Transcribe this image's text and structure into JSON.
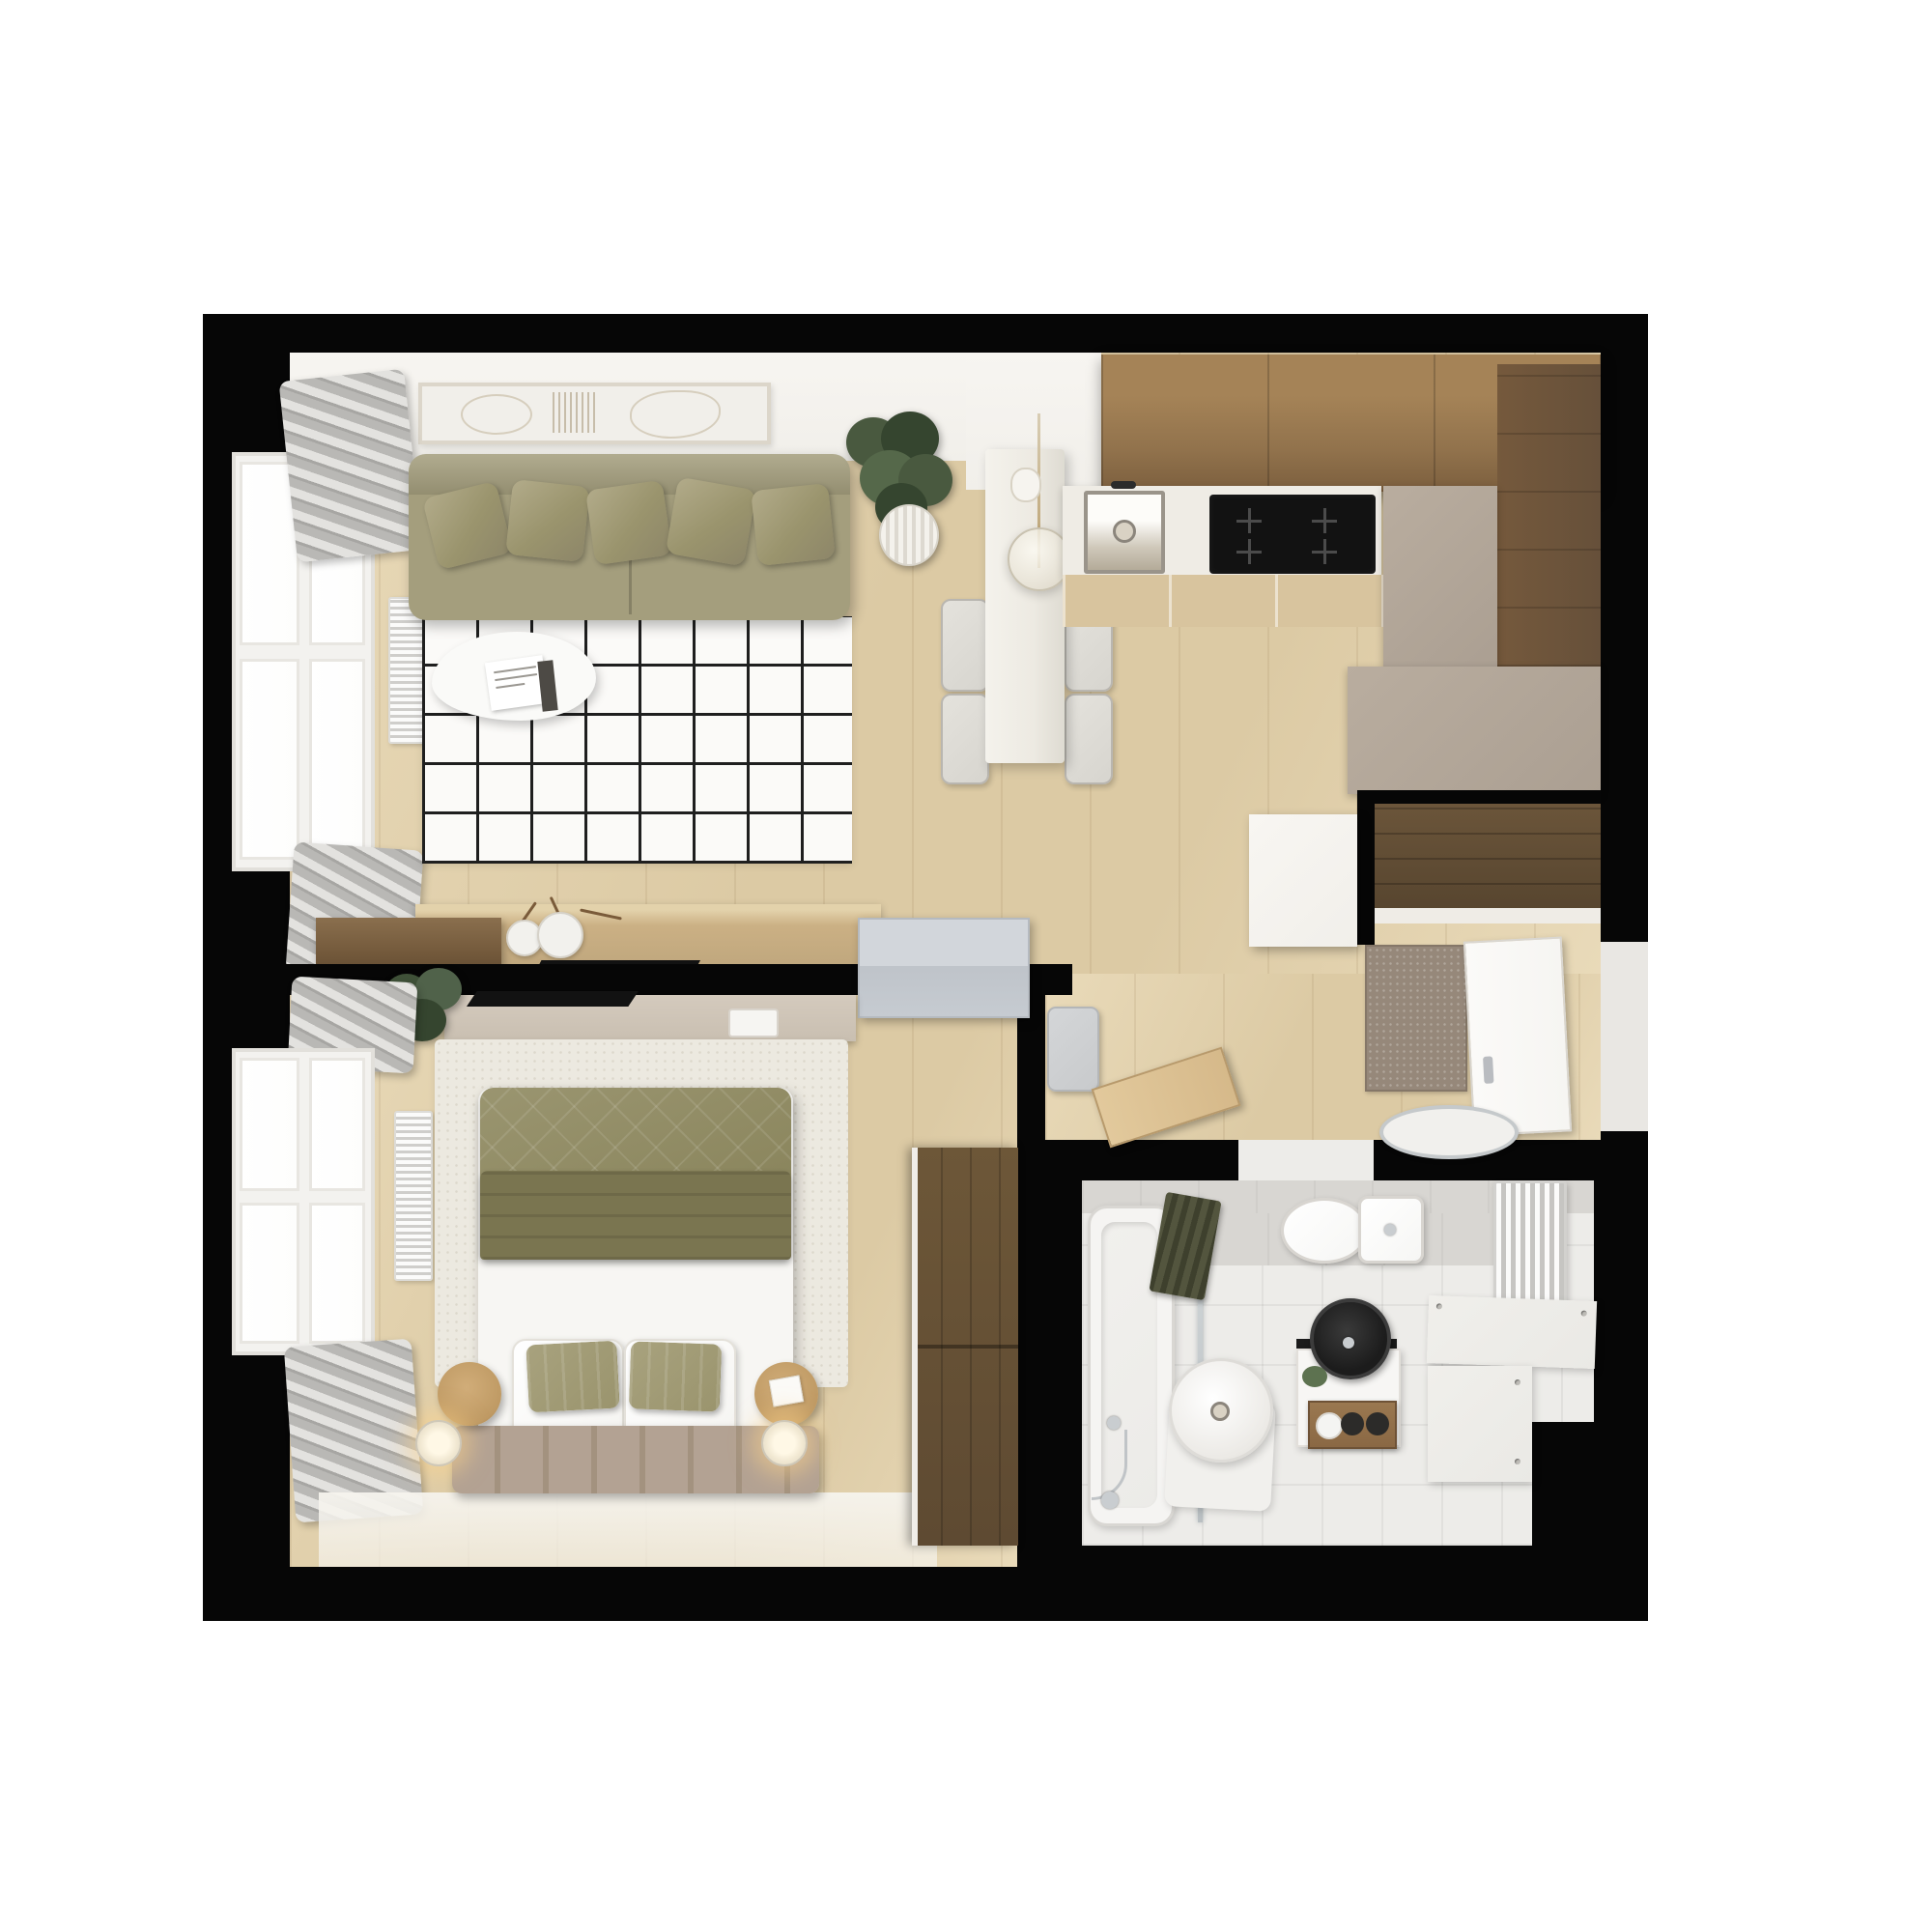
{
  "scene": {
    "kind": "apartment-floor-plan-3d-render",
    "view": "top-down",
    "style": "scandinavian-minimal",
    "visible_text": []
  },
  "colors": {
    "wall_black": "#060606",
    "wall_white": "#f1efea",
    "floor_wood": "#dccaa4",
    "floor_wood_light": "#e9dab9",
    "rug_living": "#fbfaf8",
    "rug_grid": "#1f1f1f",
    "sofa": "#a49e7d",
    "pillow_green": "#9a946d",
    "coffee_table": "#fafaf8",
    "walnut": "#73593b",
    "walnut_dark": "#57452f",
    "oak_console": "#cbb084",
    "kitchen_wood": "#91724c",
    "kitchen_wood_dark": "#66503a",
    "counter_white": "#efece5",
    "base_oak": "#d8c49e",
    "greige": "#ab9f92",
    "greige_light": "#b9ad9f",
    "cooktop": "#121212",
    "sink_steel_light": "#fdfcf9",
    "bar_counter": "#edeae2",
    "stool": "#d7d5cf",
    "stool_edge": "#b9b6b0",
    "plant_green": "#49593f",
    "plant_green_dark": "#35452f",
    "pot_white": "#eceae3",
    "curtain": "#b9b8b5",
    "curtain_light": "#e3e2df",
    "window_frame": "#f3f2ef",
    "glass": "#fdfdfc",
    "radiator_white": "#ececea",
    "door_gray": "#c6cbd1",
    "bench_gray": "#c8cacc",
    "mat_brown": "#96887a",
    "door_white": "#f6f5f2",
    "door_wood": "#d6b98a",
    "basket_white": "#f1f0ed",
    "shelf_beige": "#c9bfb1",
    "bed_rug": "#ece9e0",
    "duvet": "#8d8860",
    "duvet_fold": "#7a7550",
    "sheet_white": "#f7f6f3",
    "pillow_white": "#f5f4f1",
    "headboard_taupe": "#b3a293",
    "side_table": "#bf9a64",
    "wardrobe": "#5e4a32",
    "bath_floor": "#edece9",
    "bath_tile": "#d8d6d2",
    "tub_white": "#f5f4f2",
    "tub_inner": "#ecebe8",
    "towel_olive": "#53553e",
    "towel_olive_dark": "#3e402d",
    "toilet_white": "#f6f6f4",
    "fixture_border": "#d8d5d0",
    "sink_black": "#1c1c1c",
    "rack_wood": "#8a6844",
    "chrome": "#c9cdd0",
    "bath_bench": "#eae9e5"
  },
  "rooms": {
    "living_room": {
      "furniture": [
        "sofa",
        "sofa-pillows",
        "grid-rug",
        "coffee-table",
        "magazine",
        "wall-artwork",
        "curtains",
        "window",
        "radiator",
        "walnut-cabinet",
        "oak-console",
        "vases-with-branches",
        "wall-tv",
        "potted-plant"
      ]
    },
    "dining": {
      "furniture": [
        "bar-counter",
        "bar-stools",
        "pendant-lamp",
        "coffee-cup"
      ]
    },
    "kitchen": {
      "furniture": [
        "upper-cabinets-wood",
        "tall-dark-cabinet",
        "white-countertop",
        "steel-sink",
        "faucet",
        "induction-cooktop",
        "base-cabinets",
        "greige-cabinet-block"
      ]
    },
    "hallway_entry": {
      "furniture": [
        "entry-wardrobe-niche",
        "white-partition-block",
        "entry-mat",
        "entrance-door",
        "gray-bench",
        "bathroom-door",
        "laundry-basket",
        "bedroom-sliding-door"
      ]
    },
    "bedroom": {
      "furniture": [
        "bed",
        "green-duvet",
        "white-sheets",
        "pillows",
        "channel-headboard",
        "round-side-tables",
        "reading-lamps",
        "cream-rug",
        "media-shelf",
        "wall-tv",
        "potted-plant",
        "curtains",
        "window",
        "radiator",
        "wardrobe"
      ]
    },
    "bathroom": {
      "furniture": [
        "bathtub",
        "hand-shower",
        "glass-screen",
        "hanging-towel",
        "freestanding-basin",
        "toilet",
        "vanity-black-sink",
        "towel-rack-rolls",
        "ladder-radiator",
        "corner-bench"
      ]
    }
  }
}
